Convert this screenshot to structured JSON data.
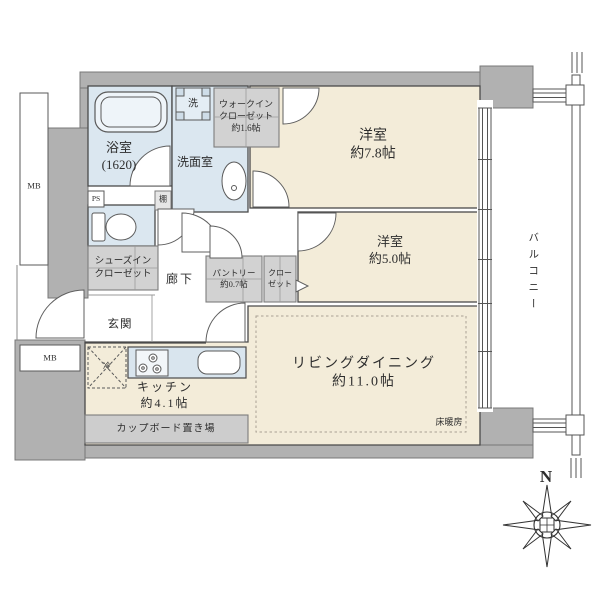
{
  "colors": {
    "wall_gray": "#b1b1b1",
    "room_floor_cream": "#f3ecd9",
    "wet_area_blue": "#dbe7f0",
    "storage_gray": "#d2d2d2",
    "cupboard_gray": "#cdcdcd",
    "line_dark": "#4a4a4a"
  },
  "labels": {
    "bathroom": "浴室\n(1620)",
    "washer": "洗",
    "walk_in_closet": "ウォークイン\nクローゼット\n約1.6帖",
    "washroom": "洗面室",
    "bedroom1": "洋室\n約7.8帖",
    "bedroom2": "洋室\n約5.0帖",
    "living_dining": "リビングダイニング\n約11.0帖",
    "floor_heating": "床暖房",
    "kitchen": "キッチン\n約4.1帖",
    "cupboard_space": "カップボード置き場",
    "pantry": "パントリー\n約0.7帖",
    "closet": "クロー\nゼット",
    "shoes_in_closet": "シューズイン\nクローゼット",
    "hallway": "廊下",
    "entrance": "玄関",
    "balcony": "バルコニー",
    "meter_box_upper": "MB",
    "meter_box_lower": "MB",
    "pipe_space": "PS",
    "shelf": "棚",
    "refrigerator": "冷",
    "compass_north": "N"
  }
}
